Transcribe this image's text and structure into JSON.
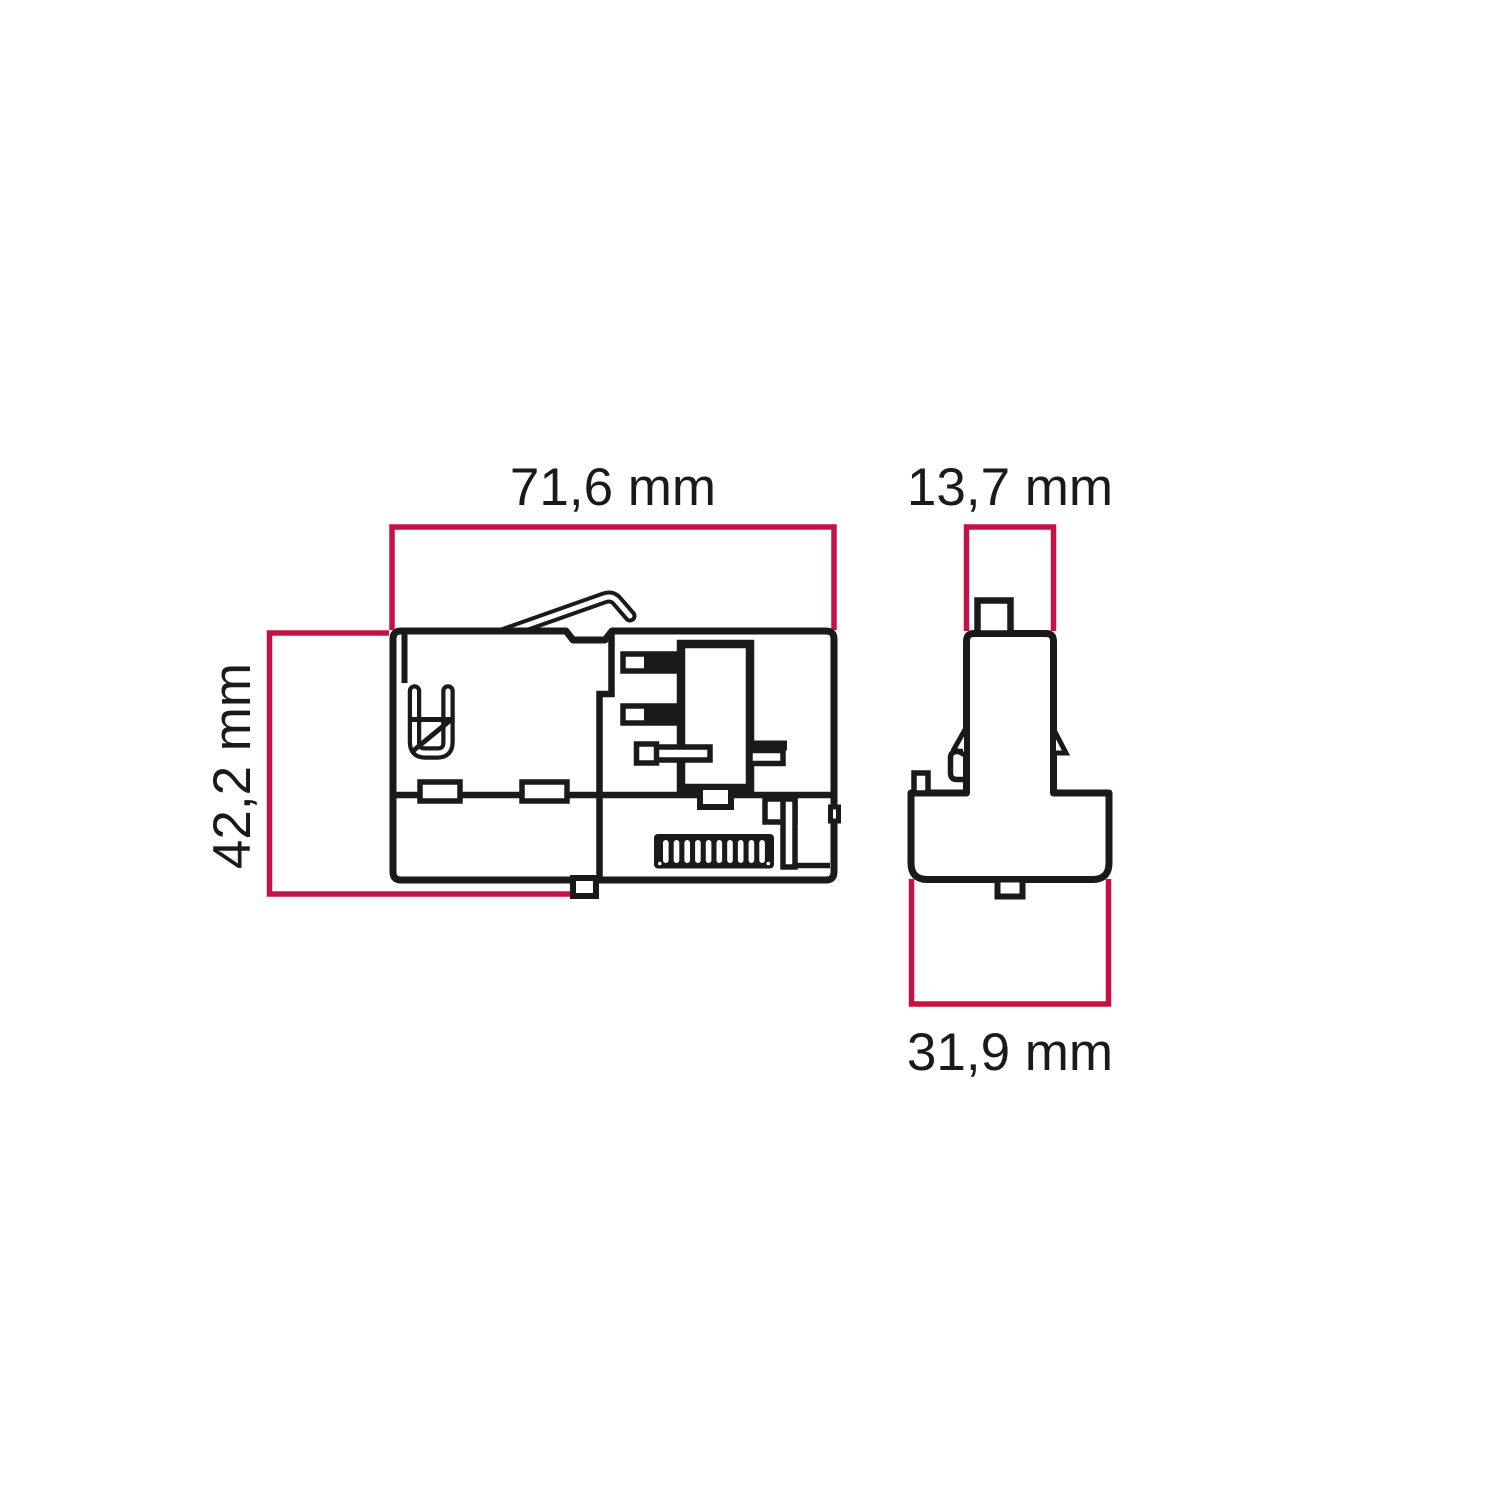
{
  "figure": {
    "type": "technical-dimension-drawing",
    "views": {
      "side_view": {
        "width_label": "71,6 mm",
        "height_label": "42,2 mm"
      },
      "front_view": {
        "stem_width_label": "13,7 mm",
        "body_width_label": "31,9 mm"
      }
    },
    "colors": {
      "line": "#1a1a1a",
      "dimension_line": "#c31345",
      "background": "#ffffff"
    }
  }
}
